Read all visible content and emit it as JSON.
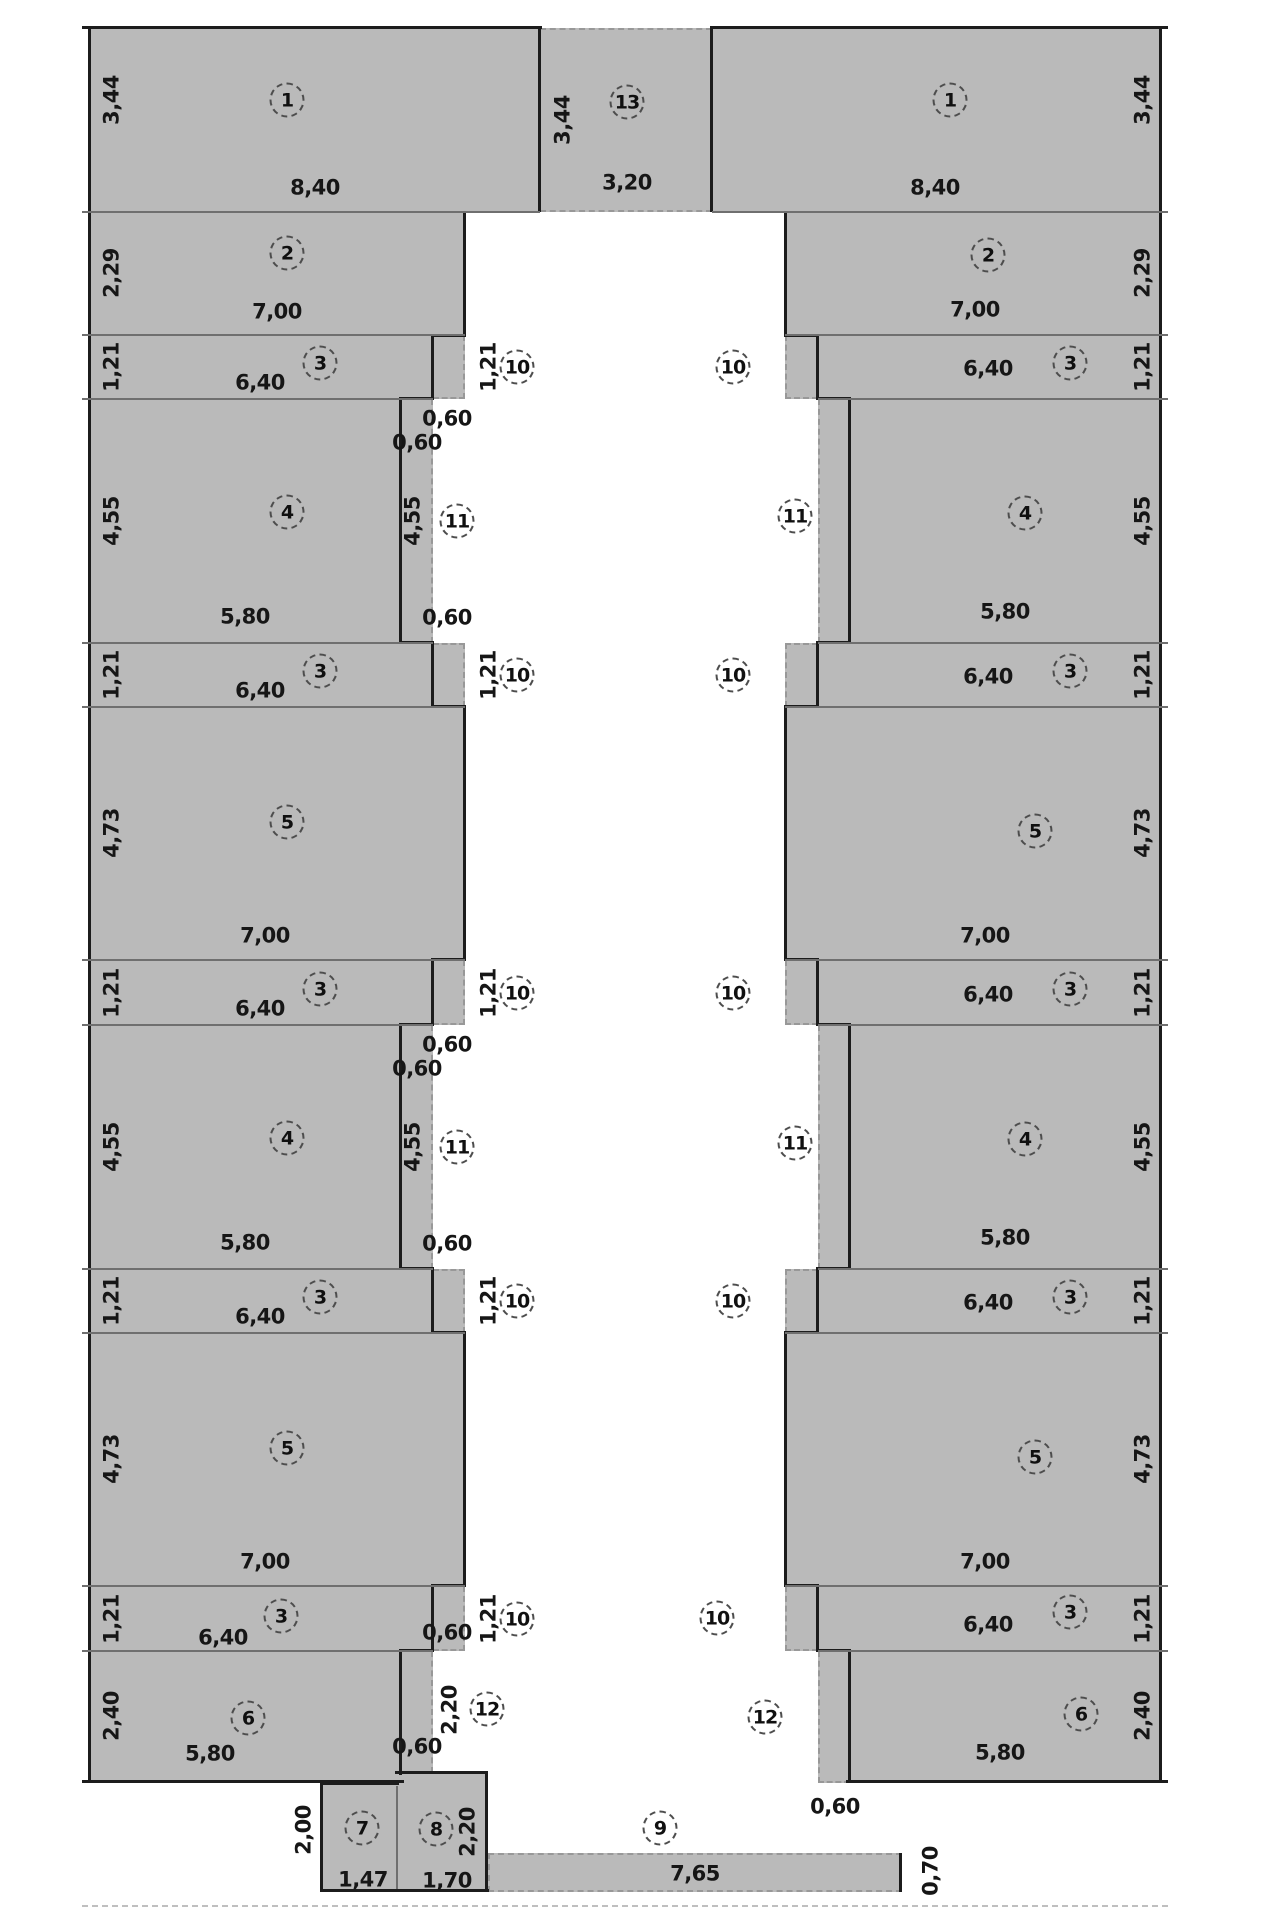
{
  "drawing": {
    "kind": "floor-plan",
    "units_decimal_separator": ",",
    "colors": {
      "fill": "#bababa",
      "wall": "#1c1c1c",
      "dashed_edge": "#989898",
      "text": "#161616"
    }
  },
  "circles": [
    {
      "id": "circle-1-left",
      "text": "1"
    },
    {
      "id": "circle-2-left",
      "text": "2"
    },
    {
      "id": "circle-3-left-1",
      "text": "3"
    },
    {
      "id": "circle-3-left-2",
      "text": "3"
    },
    {
      "id": "circle-3-left-3",
      "text": "3"
    },
    {
      "id": "circle-3-left-4",
      "text": "3"
    },
    {
      "id": "circle-3-left-5",
      "text": "3"
    },
    {
      "id": "circle-4-left-1",
      "text": "4"
    },
    {
      "id": "circle-4-left-2",
      "text": "4"
    },
    {
      "id": "circle-5-left-1",
      "text": "5"
    },
    {
      "id": "circle-5-left-2",
      "text": "5"
    },
    {
      "id": "circle-6-left",
      "text": "6"
    },
    {
      "id": "circle-7",
      "text": "7"
    },
    {
      "id": "circle-8",
      "text": "8"
    },
    {
      "id": "circle-9",
      "text": "9"
    },
    {
      "id": "circle-13",
      "text": "13"
    },
    {
      "id": "circle-10-left-1",
      "text": "10"
    },
    {
      "id": "circle-10-left-2",
      "text": "10"
    },
    {
      "id": "circle-10-left-3",
      "text": "10"
    },
    {
      "id": "circle-10-left-4",
      "text": "10"
    },
    {
      "id": "circle-10-left-5",
      "text": "10"
    },
    {
      "id": "circle-11-left-1",
      "text": "11"
    },
    {
      "id": "circle-11-left-2",
      "text": "11"
    },
    {
      "id": "circle-12-left",
      "text": "12"
    },
    {
      "id": "circle-1-right",
      "text": "1"
    },
    {
      "id": "circle-2-right",
      "text": "2"
    },
    {
      "id": "circle-3-right-1",
      "text": "3"
    },
    {
      "id": "circle-3-right-2",
      "text": "3"
    },
    {
      "id": "circle-3-right-3",
      "text": "3"
    },
    {
      "id": "circle-3-right-4",
      "text": "3"
    },
    {
      "id": "circle-3-right-5",
      "text": "3"
    },
    {
      "id": "circle-4-right-1",
      "text": "4"
    },
    {
      "id": "circle-4-right-2",
      "text": "4"
    },
    {
      "id": "circle-5-right-1",
      "text": "5"
    },
    {
      "id": "circle-5-right-2",
      "text": "5"
    },
    {
      "id": "circle-6-right",
      "text": "6"
    },
    {
      "id": "circle-10-right-1",
      "text": "10"
    },
    {
      "id": "circle-10-right-2",
      "text": "10"
    },
    {
      "id": "circle-10-right-3",
      "text": "10"
    },
    {
      "id": "circle-10-right-4",
      "text": "10"
    },
    {
      "id": "circle-10-right-5",
      "text": "10"
    },
    {
      "id": "circle-11-right-1",
      "text": "11"
    },
    {
      "id": "circle-11-right-2",
      "text": "11"
    },
    {
      "id": "circle-12-right",
      "text": "12"
    }
  ],
  "dim_labels": [
    {
      "id": "dim-z1-left-w",
      "text": "8,40"
    },
    {
      "id": "dim-z2-left-w",
      "text": "7,00"
    },
    {
      "id": "dim-z3-left-1-w",
      "text": "6,40"
    },
    {
      "id": "dim-z3-left-2-w",
      "text": "6,40"
    },
    {
      "id": "dim-z3-left-3-w",
      "text": "6,40"
    },
    {
      "id": "dim-z3-left-4-w",
      "text": "6,40"
    },
    {
      "id": "dim-z3-left-5-w",
      "text": "6,40"
    },
    {
      "id": "dim-z4-left-1-w",
      "text": "5,80"
    },
    {
      "id": "dim-z4-left-2-w",
      "text": "5,80"
    },
    {
      "id": "dim-z5-left-1-w",
      "text": "7,00"
    },
    {
      "id": "dim-z5-left-2-w",
      "text": "7,00"
    },
    {
      "id": "dim-z6-left-w",
      "text": "5,80"
    },
    {
      "id": "dim-060-left-1",
      "text": "0,60"
    },
    {
      "id": "dim-060-left-2",
      "text": "0,60"
    },
    {
      "id": "dim-060-left-3",
      "text": "0,60"
    },
    {
      "id": "dim-060-left-4",
      "text": "0,60"
    },
    {
      "id": "dim-060-left-5",
      "text": "0,60"
    },
    {
      "id": "dim-060-left-6",
      "text": "0,60"
    },
    {
      "id": "dim-060-left-7",
      "text": "0,60"
    },
    {
      "id": "dim-060-left-8",
      "text": "0,60"
    },
    {
      "id": "dim-z7-w",
      "text": "1,47"
    },
    {
      "id": "dim-z8-w",
      "text": "1,70"
    },
    {
      "id": "dim-z9-w",
      "text": "7,65"
    },
    {
      "id": "dim-z13-w",
      "text": "3,20"
    },
    {
      "id": "dim-z1-right-w",
      "text": "8,40"
    },
    {
      "id": "dim-z2-right-w",
      "text": "7,00"
    },
    {
      "id": "dim-z3-right-1-w",
      "text": "6,40"
    },
    {
      "id": "dim-z3-right-2-w",
      "text": "6,40"
    },
    {
      "id": "dim-z3-right-3-w",
      "text": "6,40"
    },
    {
      "id": "dim-z3-right-4-w",
      "text": "6,40"
    },
    {
      "id": "dim-z3-right-5-w",
      "text": "6,40"
    },
    {
      "id": "dim-z4-right-1-w",
      "text": "5,80"
    },
    {
      "id": "dim-z4-right-2-w",
      "text": "5,80"
    },
    {
      "id": "dim-z5-right-1-w",
      "text": "7,00"
    },
    {
      "id": "dim-z5-right-2-w",
      "text": "7,00"
    },
    {
      "id": "dim-z6-right-w",
      "text": "5,80"
    },
    {
      "id": "dim-060-right-1",
      "text": "0,60"
    },
    {
      "id": "dim-wallL-z1-h",
      "text": "3,44"
    },
    {
      "id": "dim-wallL-z2-h",
      "text": "2,29"
    },
    {
      "id": "dim-wallL-z3-1-h",
      "text": "1,21"
    },
    {
      "id": "dim-wallL-z4-1-h",
      "text": "4,55"
    },
    {
      "id": "dim-wallL-z3-2-h",
      "text": "1,21"
    },
    {
      "id": "dim-wallL-z5-1-h",
      "text": "4,73"
    },
    {
      "id": "dim-wallL-z3-3-h",
      "text": "1,21"
    },
    {
      "id": "dim-wallL-z4-2-h",
      "text": "4,55"
    },
    {
      "id": "dim-wallL-z3-4-h",
      "text": "1,21"
    },
    {
      "id": "dim-wallL-z5-2-h",
      "text": "4,73"
    },
    {
      "id": "dim-wallL-z3-5-h",
      "text": "1,21"
    },
    {
      "id": "dim-wallL-z6-h",
      "text": "2,40"
    },
    {
      "id": "dim-wallR-z1-h",
      "text": "3,44"
    },
    {
      "id": "dim-wallR-z2-h",
      "text": "2,29"
    },
    {
      "id": "dim-wallR-z3-1-h",
      "text": "1,21"
    },
    {
      "id": "dim-wallR-z4-1-h",
      "text": "4,55"
    },
    {
      "id": "dim-wallR-z3-2-h",
      "text": "1,21"
    },
    {
      "id": "dim-wallR-z5-1-h",
      "text": "4,73"
    },
    {
      "id": "dim-wallR-z3-3-h",
      "text": "1,21"
    },
    {
      "id": "dim-wallR-z4-2-h",
      "text": "4,55"
    },
    {
      "id": "dim-wallR-z3-4-h",
      "text": "1,21"
    },
    {
      "id": "dim-wallR-z5-2-h",
      "text": "4,73"
    },
    {
      "id": "dim-wallR-z3-5-h",
      "text": "1,21"
    },
    {
      "id": "dim-wallR-z6-h",
      "text": "2,40"
    },
    {
      "id": "dim-z13-h",
      "text": "3,44"
    },
    {
      "id": "dim-corr-1",
      "text": "1,21"
    },
    {
      "id": "dim-corr-2",
      "text": "1,21"
    },
    {
      "id": "dim-corr-3",
      "text": "1,21"
    },
    {
      "id": "dim-corr-4",
      "text": "1,21"
    },
    {
      "id": "dim-corr-5",
      "text": "1,21"
    },
    {
      "id": "dim-strip11-1-h",
      "text": "4,55"
    },
    {
      "id": "dim-strip11-2-h",
      "text": "4,55"
    },
    {
      "id": "dim-strip12-h",
      "text": "2,20"
    },
    {
      "id": "dim-z7-h",
      "text": "2,00"
    },
    {
      "id": "dim-z8-h",
      "text": "2,20"
    },
    {
      "id": "dim-z9-h",
      "text": "0,70"
    }
  ]
}
